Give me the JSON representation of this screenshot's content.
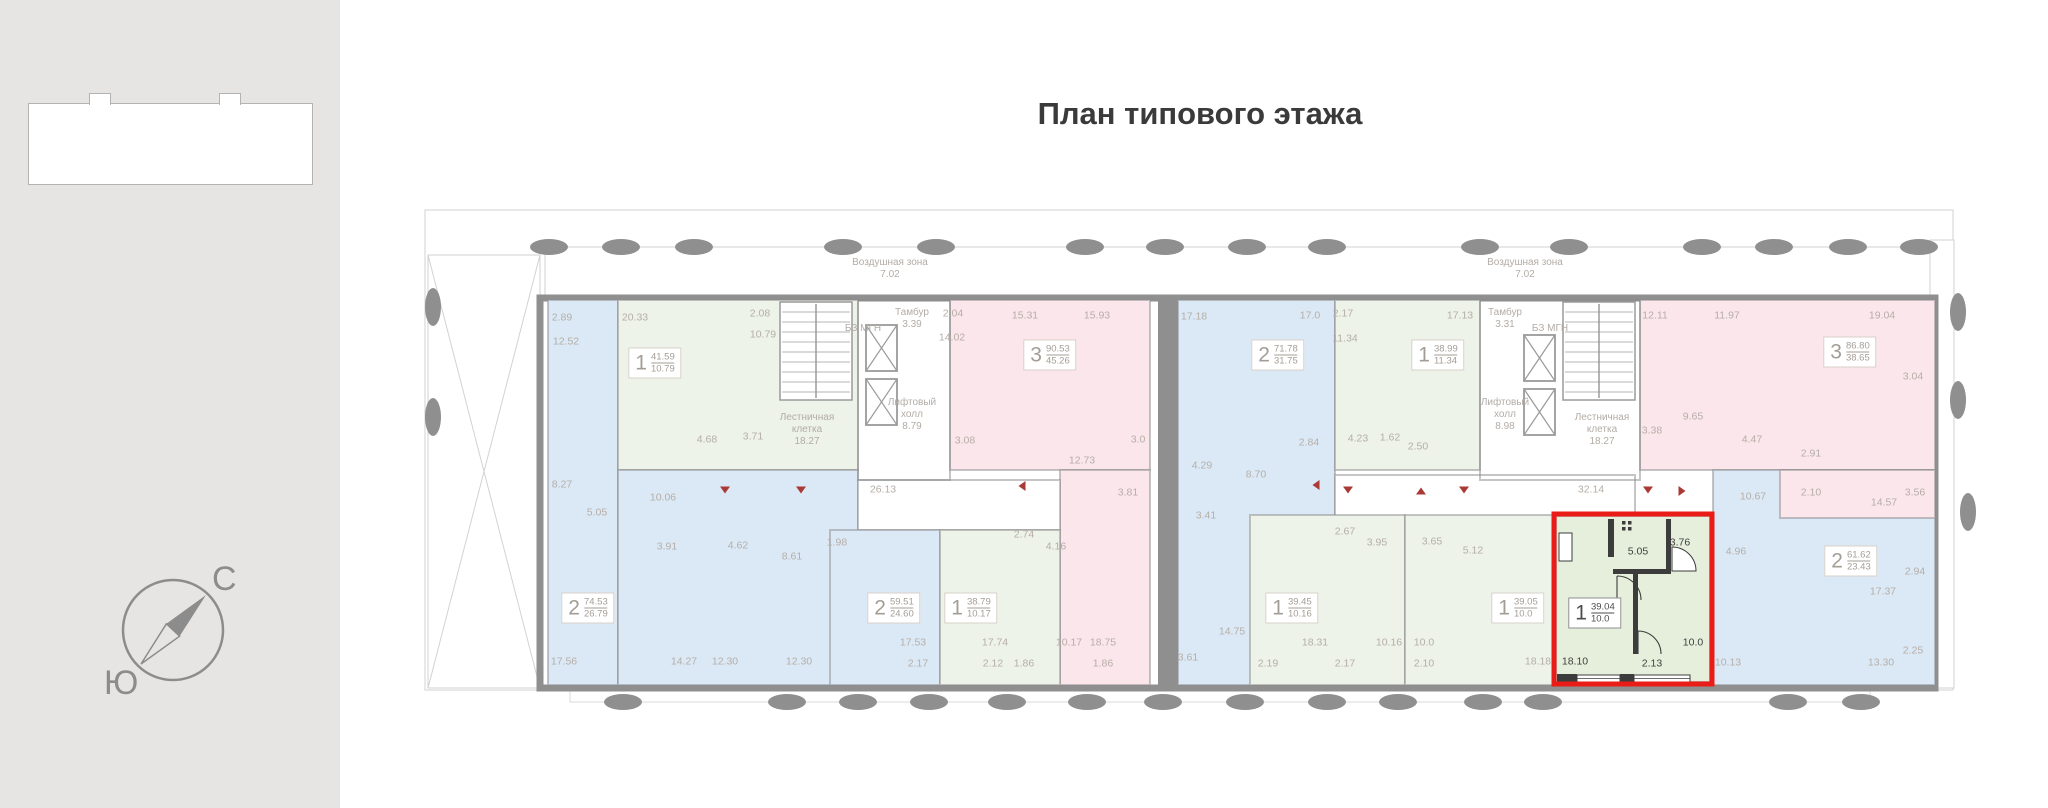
{
  "page": {
    "title": "План типового этажа"
  },
  "sidebar": {
    "compass": {
      "north_label": "С",
      "south_label": "Ю"
    }
  },
  "plan": {
    "colors": {
      "wall": "#8f8f8f",
      "thin": "#d2d2d2",
      "green": "#edf3e8",
      "blue": "#dbe9f6",
      "pink": "#fbe6ec",
      "hl": "#e6efdc",
      "highlight_border": "#e91c17",
      "label": "#b6aea7",
      "label_dark": "#3f3f3f",
      "white": "#ffffff"
    },
    "regions": [
      {
        "name": "apt-strip-left",
        "fill": "blue",
        "x": 128,
        "y": 115,
        "w": 70,
        "h": 385,
        "inter": true
      },
      {
        "name": "apt-1-41-59",
        "fill": "green",
        "x": 198,
        "y": 115,
        "w": 240,
        "h": 170,
        "inter": true
      },
      {
        "name": "apt-2-74-53",
        "fill": "blue",
        "x": 198,
        "y": 285,
        "w": 240,
        "h": 215,
        "inter": true
      },
      {
        "name": "apt-3-90-53",
        "fill": "pink",
        "x": 530,
        "y": 115,
        "w": 200,
        "h": 170,
        "inter": true
      },
      {
        "name": "apt-pink-strip-left",
        "fill": "pink",
        "x": 640,
        "y": 285,
        "w": 90,
        "h": 215,
        "inter": true
      },
      {
        "name": "corridor-left",
        "fill": "white",
        "x": 438,
        "y": 295,
        "w": 202,
        "h": 50,
        "inter": false
      },
      {
        "name": "apt-2-59-51",
        "fill": "blue",
        "x": 410,
        "y": 345,
        "w": 110,
        "h": 155,
        "inter": true
      },
      {
        "name": "apt-1-38-79",
        "fill": "green",
        "x": 520,
        "y": 345,
        "w": 120,
        "h": 155,
        "inter": true
      },
      {
        "name": "apt-2-71-78",
        "fill": "blue",
        "x": 758,
        "y": 115,
        "w": 157,
        "h": 385,
        "inter": true
      },
      {
        "name": "apt-1-38-99",
        "fill": "green",
        "x": 915,
        "y": 115,
        "w": 145,
        "h": 170,
        "inter": true
      },
      {
        "name": "corridor-right",
        "fill": "white",
        "x": 915,
        "y": 290,
        "w": 300,
        "h": 45,
        "inter": false
      },
      {
        "name": "apt-1-39-45",
        "fill": "green",
        "x": 830,
        "y": 330,
        "w": 155,
        "h": 170,
        "inter": true
      },
      {
        "name": "apt-1-39-05",
        "fill": "green",
        "x": 985,
        "y": 330,
        "w": 148,
        "h": 170,
        "inter": true
      },
      {
        "name": "apt-3-86-80",
        "fill": "pink",
        "x": 1220,
        "y": 115,
        "w": 295,
        "h": 170,
        "inter": true
      },
      {
        "name": "apt-2-61-62",
        "fill": "blue",
        "x": 1293,
        "y": 285,
        "w": 222,
        "h": 215,
        "inter": true
      },
      {
        "name": "apt-pink-ext-right",
        "fill": "pink",
        "x": 1360,
        "y": 285,
        "w": 155,
        "h": 48,
        "inter": true
      },
      {
        "name": "apt-1-39-04-selected",
        "fill": "hl",
        "x": 1136,
        "y": 331,
        "w": 154,
        "h": 166,
        "inter": true
      }
    ],
    "highlight": {
      "x": 1134,
      "y": 329,
      "w": 158,
      "h": 170
    },
    "apartments": [
      {
        "n": "1",
        "total": "41.59",
        "living": "10.79",
        "x": 235,
        "y": 178
      },
      {
        "n": "3",
        "total": "90.53",
        "living": "45.26",
        "x": 630,
        "y": 170
      },
      {
        "n": "2",
        "total": "71.78",
        "living": "31.75",
        "x": 858,
        "y": 170
      },
      {
        "n": "1",
        "total": "38.99",
        "living": "11.34",
        "x": 1018,
        "y": 170
      },
      {
        "n": "3",
        "total": "86.80",
        "living": "38.65",
        "x": 1430,
        "y": 167
      },
      {
        "n": "2",
        "total": "74.53",
        "living": "26.79",
        "x": 168,
        "y": 423
      },
      {
        "n": "2",
        "total": "59.51",
        "living": "24.60",
        "x": 474,
        "y": 423
      },
      {
        "n": "1",
        "total": "38.79",
        "living": "10.17",
        "x": 551,
        "y": 423
      },
      {
        "n": "1",
        "total": "39.45",
        "living": "10.16",
        "x": 872,
        "y": 423
      },
      {
        "n": "1",
        "total": "39.05",
        "living": "10.0",
        "x": 1098,
        "y": 423
      },
      {
        "n": "1",
        "total": "39.04",
        "living": "10.0",
        "x": 1175,
        "y": 428,
        "hl": true
      },
      {
        "n": "2",
        "total": "61.62",
        "living": "23.43",
        "x": 1431,
        "y": 376
      }
    ],
    "zone_labels": [
      {
        "lines": [
          "Воздушная зона",
          "7.02"
        ],
        "x": 470,
        "y": 72
      },
      {
        "lines": [
          "Воздушная зона",
          "7.02"
        ],
        "x": 1105,
        "y": 72
      },
      {
        "lines": [
          "Тамбур",
          "3.39"
        ],
        "x": 492,
        "y": 122
      },
      {
        "lines": [
          "БЗ МГН"
        ],
        "x": 443,
        "y": 138
      },
      {
        "lines": [
          "Лифтовый",
          "холл",
          "8.79"
        ],
        "x": 492,
        "y": 212
      },
      {
        "lines": [
          "Лестничная",
          "клетка",
          "18.27"
        ],
        "x": 387,
        "y": 227
      },
      {
        "lines": [
          "Тамбур",
          "3.31"
        ],
        "x": 1085,
        "y": 122
      },
      {
        "lines": [
          "БЗ МГН"
        ],
        "x": 1130,
        "y": 138
      },
      {
        "lines": [
          "Лифтовый",
          "холл",
          "8.98"
        ],
        "x": 1085,
        "y": 212
      },
      {
        "lines": [
          "Лестничная",
          "клетка",
          "18.27"
        ],
        "x": 1182,
        "y": 227
      }
    ],
    "room_labels": [
      {
        "t": "2.89",
        "x": 142,
        "y": 133
      },
      {
        "t": "12.52",
        "x": 146,
        "y": 157
      },
      {
        "t": "20.33",
        "x": 215,
        "y": 133
      },
      {
        "t": "2.08",
        "x": 340,
        "y": 129
      },
      {
        "t": "10.79",
        "x": 343,
        "y": 150
      },
      {
        "t": "4.68",
        "x": 287,
        "y": 255
      },
      {
        "t": "3.71",
        "x": 333,
        "y": 252
      },
      {
        "t": "2.04",
        "x": 533,
        "y": 129
      },
      {
        "t": "14.02",
        "x": 532,
        "y": 153
      },
      {
        "t": "15.31",
        "x": 605,
        "y": 131
      },
      {
        "t": "15.93",
        "x": 677,
        "y": 131
      },
      {
        "t": "3.08",
        "x": 545,
        "y": 256
      },
      {
        "t": "12.73",
        "x": 662,
        "y": 276
      },
      {
        "t": "3.0",
        "x": 718,
        "y": 255
      },
      {
        "t": "17.18",
        "x": 774,
        "y": 132
      },
      {
        "t": "17.0",
        "x": 890,
        "y": 131
      },
      {
        "t": "2.17",
        "x": 923,
        "y": 129
      },
      {
        "t": "11.34",
        "x": 925,
        "y": 154
      },
      {
        "t": "17.13",
        "x": 1040,
        "y": 131
      },
      {
        "t": "4.23",
        "x": 938,
        "y": 254
      },
      {
        "t": "1.62",
        "x": 970,
        "y": 253
      },
      {
        "t": "2.50",
        "x": 998,
        "y": 262
      },
      {
        "t": "2.84",
        "x": 889,
        "y": 258
      },
      {
        "t": "8.70",
        "x": 836,
        "y": 290
      },
      {
        "t": "4.29",
        "x": 782,
        "y": 281
      },
      {
        "t": "3.41",
        "x": 786,
        "y": 331
      },
      {
        "t": "12.11",
        "x": 1235,
        "y": 131
      },
      {
        "t": "11.97",
        "x": 1307,
        "y": 131
      },
      {
        "t": "19.04",
        "x": 1462,
        "y": 131
      },
      {
        "t": "3.04",
        "x": 1493,
        "y": 192
      },
      {
        "t": "9.65",
        "x": 1273,
        "y": 232
      },
      {
        "t": "3.38",
        "x": 1232,
        "y": 246
      },
      {
        "t": "4.47",
        "x": 1332,
        "y": 255
      },
      {
        "t": "2.91",
        "x": 1391,
        "y": 269
      },
      {
        "t": "8.27",
        "x": 142,
        "y": 300
      },
      {
        "t": "5.05",
        "x": 177,
        "y": 328
      },
      {
        "t": "10.06",
        "x": 243,
        "y": 313
      },
      {
        "t": "3.91",
        "x": 247,
        "y": 362
      },
      {
        "t": "4.62",
        "x": 318,
        "y": 361
      },
      {
        "t": "8.61",
        "x": 372,
        "y": 372
      },
      {
        "t": "17.56",
        "x": 144,
        "y": 477
      },
      {
        "t": "14.27",
        "x": 264,
        "y": 477
      },
      {
        "t": "12.30",
        "x": 305,
        "y": 477
      },
      {
        "t": "12.30",
        "x": 379,
        "y": 477
      },
      {
        "t": "1.98",
        "x": 417,
        "y": 358
      },
      {
        "t": "26.13",
        "x": 463,
        "y": 305
      },
      {
        "t": "17.53",
        "x": 493,
        "y": 458
      },
      {
        "t": "2.17",
        "x": 498,
        "y": 479
      },
      {
        "t": "2.74",
        "x": 604,
        "y": 350
      },
      {
        "t": "4.16",
        "x": 636,
        "y": 362
      },
      {
        "t": "17.74",
        "x": 575,
        "y": 458
      },
      {
        "t": "2.12",
        "x": 573,
        "y": 479
      },
      {
        "t": "10.17",
        "x": 649,
        "y": 458
      },
      {
        "t": "1.86",
        "x": 604,
        "y": 479
      },
      {
        "t": "18.75",
        "x": 683,
        "y": 458
      },
      {
        "t": "1.86",
        "x": 683,
        "y": 479
      },
      {
        "t": "3.81",
        "x": 708,
        "y": 308
      },
      {
        "t": "32.14",
        "x": 1171,
        "y": 305
      },
      {
        "t": "14.75",
        "x": 812,
        "y": 447
      },
      {
        "t": "3.61",
        "x": 768,
        "y": 473
      },
      {
        "t": "2.67",
        "x": 925,
        "y": 347
      },
      {
        "t": "3.95",
        "x": 957,
        "y": 358
      },
      {
        "t": "18.31",
        "x": 895,
        "y": 458
      },
      {
        "t": "2.19",
        "x": 848,
        "y": 479
      },
      {
        "t": "10.16",
        "x": 969,
        "y": 458
      },
      {
        "t": "2.17",
        "x": 925,
        "y": 479
      },
      {
        "t": "3.65",
        "x": 1012,
        "y": 357
      },
      {
        "t": "5.12",
        "x": 1053,
        "y": 366
      },
      {
        "t": "10.0",
        "x": 1004,
        "y": 458
      },
      {
        "t": "2.10",
        "x": 1004,
        "y": 479
      },
      {
        "t": "18.18",
        "x": 1118,
        "y": 477
      },
      {
        "t": "5.05",
        "x": 1218,
        "y": 367,
        "d": 1
      },
      {
        "t": "3.76",
        "x": 1260,
        "y": 358,
        "d": 1
      },
      {
        "t": "18.10",
        "x": 1155,
        "y": 477,
        "d": 1
      },
      {
        "t": "2.13",
        "x": 1232,
        "y": 479,
        "d": 1
      },
      {
        "t": "10.0",
        "x": 1273,
        "y": 458,
        "d": 1
      },
      {
        "t": "4.96",
        "x": 1316,
        "y": 367
      },
      {
        "t": "10.67",
        "x": 1333,
        "y": 312
      },
      {
        "t": "17.37",
        "x": 1463,
        "y": 407
      },
      {
        "t": "2.94",
        "x": 1495,
        "y": 387
      },
      {
        "t": "2.25",
        "x": 1493,
        "y": 466
      },
      {
        "t": "10.13",
        "x": 1308,
        "y": 478
      },
      {
        "t": "13.30",
        "x": 1461,
        "y": 478
      },
      {
        "t": "2.10",
        "x": 1391,
        "y": 308
      },
      {
        "t": "14.57",
        "x": 1464,
        "y": 318
      },
      {
        "t": "3.56",
        "x": 1495,
        "y": 308
      }
    ],
    "vent_arrows": [
      {
        "x": 305,
        "y": 305,
        "d": "down"
      },
      {
        "x": 381,
        "y": 305,
        "d": "down"
      },
      {
        "x": 602,
        "y": 301,
        "d": "left"
      },
      {
        "x": 896,
        "y": 300,
        "d": "left"
      },
      {
        "x": 928,
        "y": 305,
        "d": "down"
      },
      {
        "x": 1001,
        "y": 306,
        "d": "up"
      },
      {
        "x": 1044,
        "y": 305,
        "d": "down"
      },
      {
        "x": 1228,
        "y": 305,
        "d": "down"
      },
      {
        "x": 1262,
        "y": 306,
        "d": "right"
      }
    ],
    "balconies": {
      "top_y": 62,
      "bottom_y": 517,
      "top": [
        129,
        201,
        274,
        423,
        516,
        665,
        745,
        827,
        907,
        1060,
        1149,
        1282,
        1354,
        1428,
        1499
      ],
      "bottom": [
        203,
        367,
        438,
        509,
        587,
        667,
        743,
        825,
        907,
        978,
        1063,
        1123,
        1368,
        1441
      ],
      "sides": [
        [
          13,
          122
        ],
        [
          13,
          232
        ],
        [
          1538,
          127
        ],
        [
          1538,
          215
        ],
        [
          1548,
          327
        ]
      ]
    }
  }
}
